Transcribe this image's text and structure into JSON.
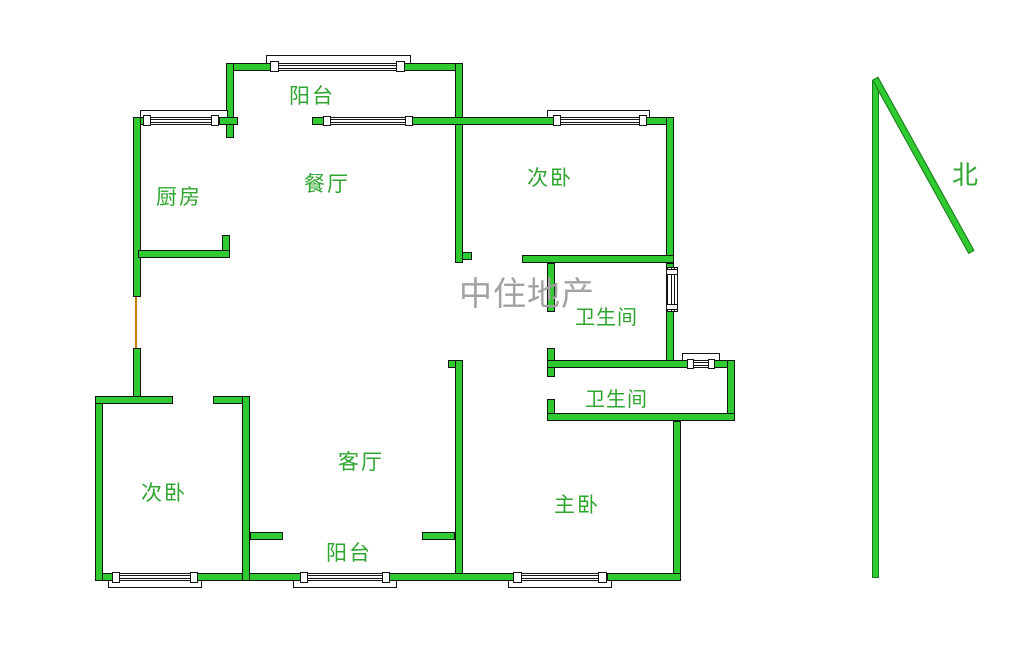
{
  "page": {
    "type": "floor-plan",
    "width": 1036,
    "height": 647,
    "background": "#ffffff"
  },
  "colors": {
    "wall_green": "#2fca2f",
    "wall_outline": "#151515",
    "label_green": "#2fa42f",
    "watermark_gray": "#a2a2a2",
    "door_orange": "#cc7a00",
    "window_fill": "#ffffff"
  },
  "rooms": [
    {
      "id": "balcony-top",
      "label": "阳台"
    },
    {
      "id": "kitchen",
      "label": "厨房"
    },
    {
      "id": "dining",
      "label": "餐厅"
    },
    {
      "id": "bedroom-top-right",
      "label": "次卧"
    },
    {
      "id": "bathroom-upper",
      "label": "卫生间"
    },
    {
      "id": "bathroom-lower",
      "label": "卫生间"
    },
    {
      "id": "bedroom-bottom-left",
      "label": "次卧"
    },
    {
      "id": "living",
      "label": "客厅"
    },
    {
      "id": "balcony-bottom",
      "label": "阳台"
    },
    {
      "id": "master-bedroom",
      "label": "主卧"
    }
  ],
  "watermark": {
    "text": "中住地产"
  },
  "compass": {
    "label": "北"
  }
}
